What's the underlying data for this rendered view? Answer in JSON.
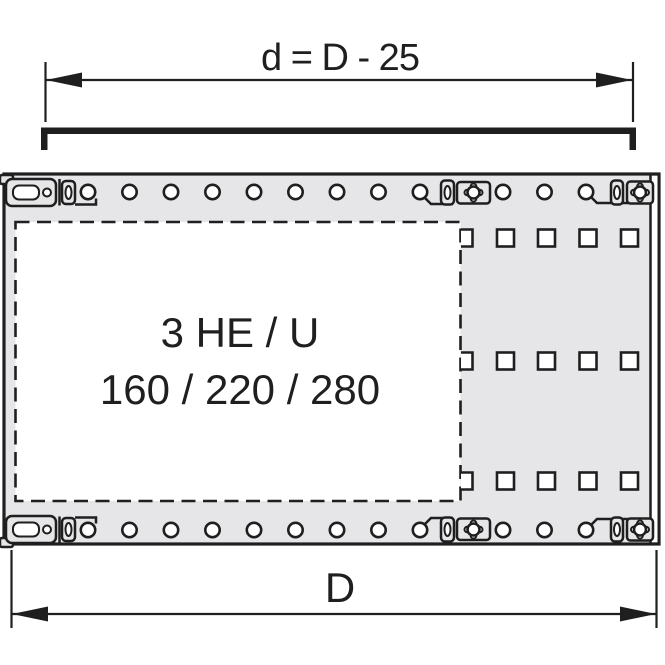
{
  "colors": {
    "line": "#1f1f1f",
    "panel_fill": "#e6e5e7",
    "hole_fill": "#ffffff"
  },
  "dimension_top": {
    "label": "d = D - 25"
  },
  "dimension_bottom": {
    "label": "D"
  },
  "panel_label": {
    "line1": "3 HE / U",
    "line2": "160 / 220 / 280"
  },
  "holes": {
    "round_x": [
      88,
      129.5,
      171,
      212.5,
      254,
      295.5,
      337,
      378.5,
      420,
      503,
      544.5,
      586
    ],
    "round_top_y": 192,
    "round_bottom_y": 530,
    "round_r": 7.2,
    "square_cols": [
      505.5,
      546.5,
      588,
      629.5
    ],
    "square_half_col_x": 461,
    "square_rows": [
      238,
      361,
      481
    ],
    "square_size": 17
  }
}
